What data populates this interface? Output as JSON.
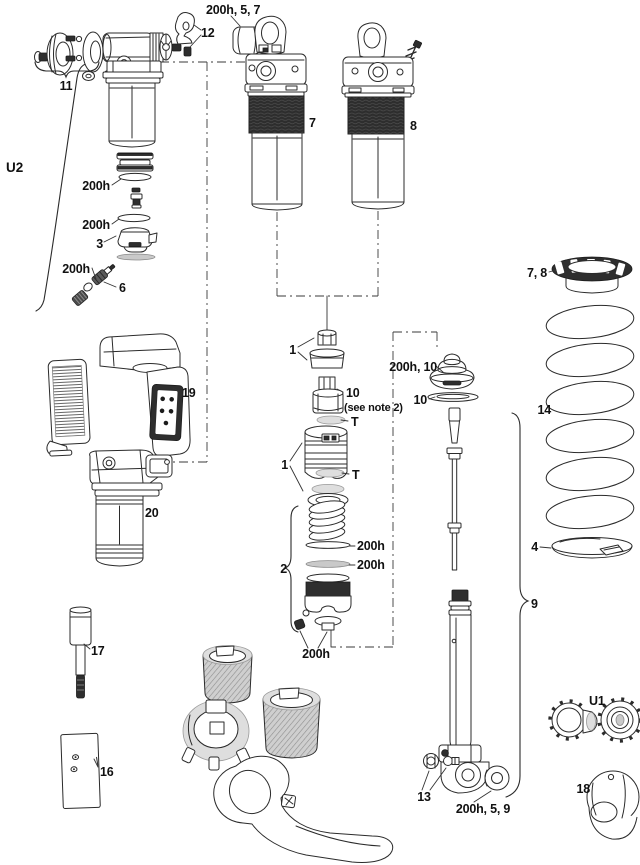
{
  "diagram": {
    "background": "#ffffff",
    "line_color": "#2b2b2b",
    "dark_fill": "#2e2e2e",
    "description": "Rear shock exploded parts diagram"
  },
  "labels": {
    "u2": "U2",
    "p11": "11",
    "p12": "12",
    "bumper_top": "200h, 5, 7",
    "p7": "7",
    "p8": "8",
    "seal_a": "200h",
    "seal_b": "200h",
    "p3": "3",
    "seal_c": "200h",
    "p6": "6",
    "p19": "19",
    "p20": "20",
    "p1a": "1",
    "p10a": "10",
    "note10": "(see note 2)",
    "t_a": "T",
    "p1b": "1",
    "t_b": "T",
    "p2": "2",
    "seal_d": "200h",
    "seal_e": "200h",
    "seal_f": "200h",
    "bumper_right": "200h, 10",
    "p10b": "10",
    "p9": "9",
    "p13": "13",
    "bushing": "200h, 5, 9",
    "collar": "7, 8",
    "p14": "14",
    "p4": "4",
    "u1": "U1",
    "p18": "18",
    "p15": "15",
    "p16": "16",
    "p17": "17"
  }
}
